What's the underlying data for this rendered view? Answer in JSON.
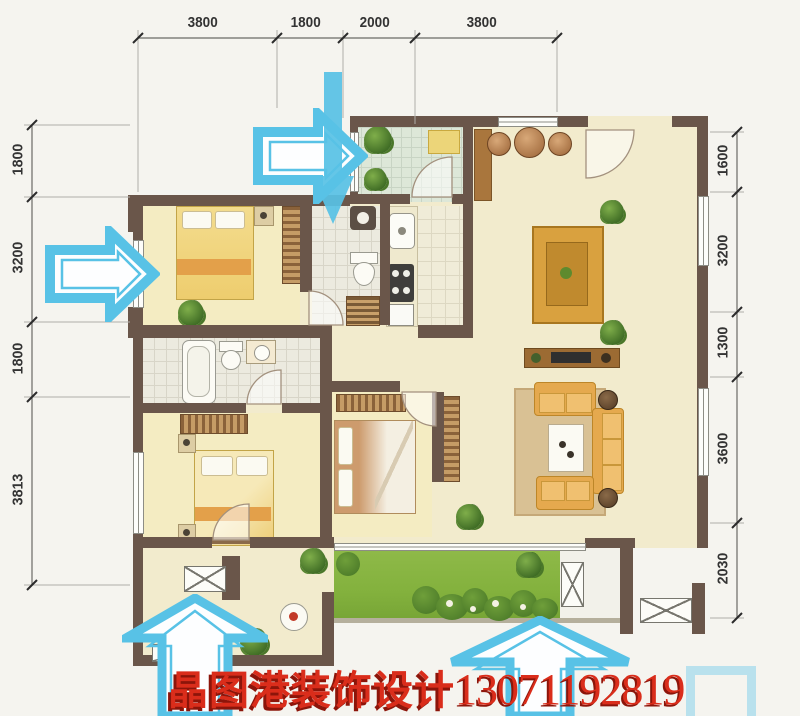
{
  "page": {
    "type": "residential floor plan photo with entry arrows and watermark"
  },
  "dimensions": {
    "top": [
      "3800",
      "1800",
      "2000",
      "3800"
    ],
    "left": [
      "1800",
      "3200",
      "1800",
      "3813"
    ],
    "right": [
      "1600",
      "3200",
      "1300",
      "3600",
      "2030"
    ]
  },
  "watermark": {
    "brand": "晶图港装饰设计",
    "phone": "13071192819"
  },
  "icons": {
    "arrows": [
      "arrow-right-icon",
      "arrow-down-icon",
      "arrow-right-icon",
      "arrow-up-icon",
      "arrow-up-icon"
    ]
  },
  "colors": {
    "wall": "#6a564a",
    "floor": "#f2ebcd",
    "bedroomFloor": "#f4ecc2",
    "tile": "#eceadf",
    "balconyTile": "#dde7d8",
    "lawn": "#83b13d",
    "shrub": "#4e7d2a",
    "arrow": "#58c2e6",
    "red": "#da2d1b",
    "redShadow": "#8c150a",
    "wood": "#a9763d",
    "orange": "#e5a94e",
    "dimInk": "#333333",
    "line": "#8f8d86"
  }
}
